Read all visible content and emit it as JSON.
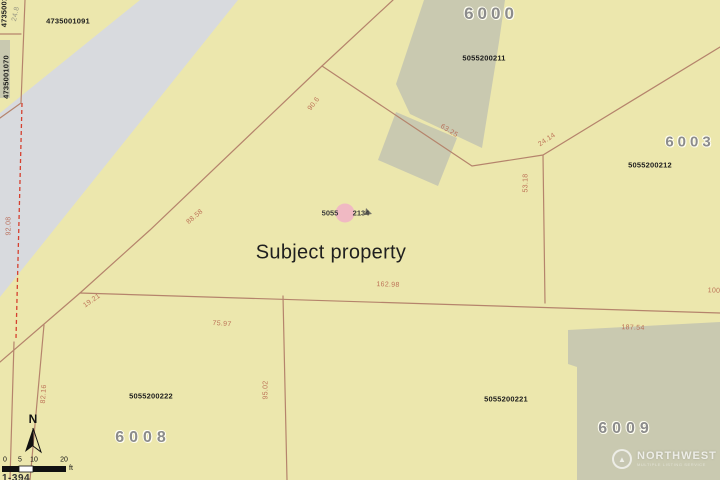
{
  "map": {
    "subject_label": "Subject property",
    "marker": {
      "left_text": "5055",
      "right_text": "2134"
    },
    "lot_numbers": [
      {
        "name": "lot-number-6000",
        "text": "6000",
        "x": 491,
        "y": 14,
        "size": 17,
        "ls": 4
      },
      {
        "name": "lot-number-6003",
        "text": "6003",
        "x": 690,
        "y": 142,
        "size": 15,
        "ls": 4
      },
      {
        "name": "lot-number-6008",
        "text": "6008",
        "x": 143,
        "y": 438,
        "size": 16,
        "ls": 5
      },
      {
        "name": "lot-number-6009",
        "text": "6009",
        "x": 626,
        "y": 429,
        "size": 16,
        "ls": 5
      }
    ],
    "parcel_ids": [
      {
        "name": "parcel-id-4735001091",
        "text": "4735001091",
        "x": 68,
        "y": 21,
        "rot": 0
      },
      {
        "name": "parcel-id-4735001070",
        "text": "4735001070",
        "x": 6,
        "y": 77,
        "rot": -90
      },
      {
        "name": "parcel-id-partial-top-left",
        "text": "4735001",
        "x": 4,
        "y": 12,
        "rot": -90
      },
      {
        "name": "parcel-id-5055200211",
        "text": "5055200211",
        "x": 484,
        "y": 58,
        "rot": 0
      },
      {
        "name": "parcel-id-5055200212",
        "text": "5055200212",
        "x": 650,
        "y": 165,
        "rot": 0
      },
      {
        "name": "parcel-id-5055200222",
        "text": "5055200222",
        "x": 151,
        "y": 396,
        "rot": 0
      },
      {
        "name": "parcel-id-5055200221",
        "text": "5055200221",
        "x": 506,
        "y": 399,
        "rot": 0
      }
    ],
    "dimensions": [
      {
        "text": "24.8",
        "x": 16,
        "y": 14,
        "rot": -78,
        "color": "gray"
      },
      {
        "text": "90.6",
        "x": 314,
        "y": 104,
        "rot": -52
      },
      {
        "text": "63.25",
        "x": 449,
        "y": 131,
        "rot": 32
      },
      {
        "text": "24.14",
        "x": 547,
        "y": 140,
        "rot": -33
      },
      {
        "text": "53.18",
        "x": 526,
        "y": 183,
        "rot": -90
      },
      {
        "text": "88.58",
        "x": 195,
        "y": 217,
        "rot": -40
      },
      {
        "text": "92.08",
        "x": 9,
        "y": 226,
        "rot": -90
      },
      {
        "text": "162.98",
        "x": 388,
        "y": 285,
        "rot": 2
      },
      {
        "text": "100",
        "x": 714,
        "y": 291,
        "rot": 2
      },
      {
        "text": "19.21",
        "x": 92,
        "y": 301,
        "rot": -35
      },
      {
        "text": "75.97",
        "x": 222,
        "y": 324,
        "rot": 4
      },
      {
        "text": "187.54",
        "x": 633,
        "y": 328,
        "rot": 2
      },
      {
        "text": "95.02",
        "x": 266,
        "y": 390,
        "rot": -90
      },
      {
        "text": "82.16",
        "x": 44,
        "y": 394,
        "rot": -86
      }
    ],
    "scale_bar": {
      "ticks": [
        {
          "text": "0",
          "x": 5
        },
        {
          "text": "5",
          "x": 20
        },
        {
          "text": "10",
          "x": 34
        },
        {
          "text": "20",
          "x": 64
        }
      ],
      "tick_y": 460,
      "unit": "ft"
    },
    "north_label": "N",
    "watermark": {
      "title": "NORTHWEST",
      "subtitle": "MULTIPLE LISTING SERVICE",
      "logo_glyph": "▲"
    },
    "page_ref": "1-394",
    "colors": {
      "parcel_fill": "#ece7ad",
      "road_fill": "#d8dade",
      "building_fill": "#c9c9b0",
      "boundary_line": "#b5846c",
      "dashed_line": "#d5402f",
      "dimension_text": "#b5604a",
      "lot_number_text": "#8c8c8c",
      "parcel_id_text": "#1c1c1c",
      "marker_pink": "#f0b6c4"
    }
  }
}
